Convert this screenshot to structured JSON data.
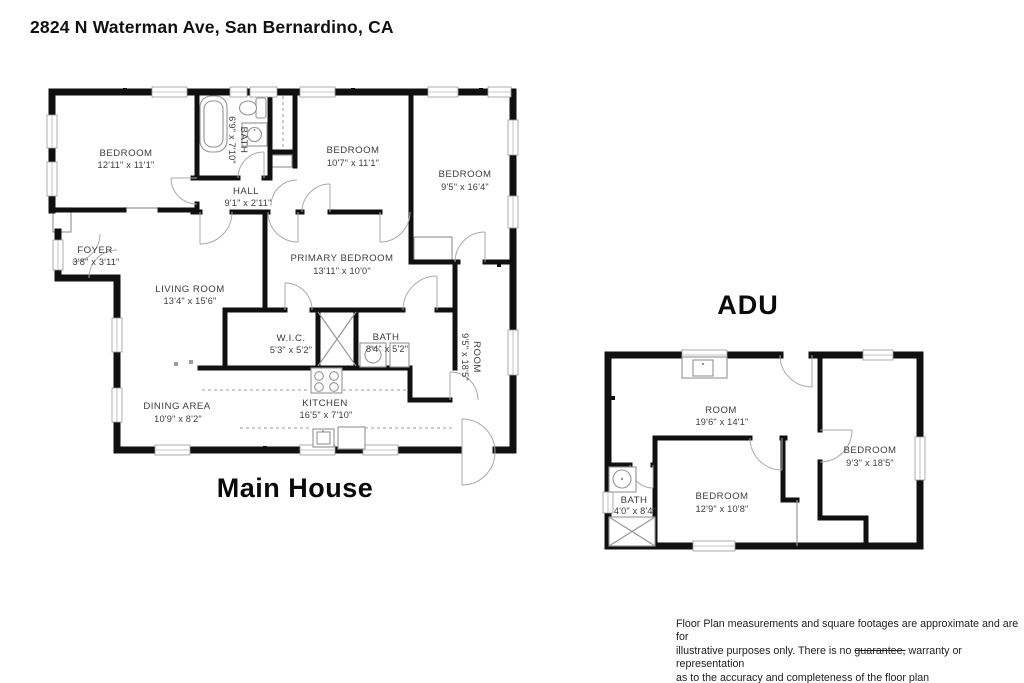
{
  "title": "2824 N Waterman Ave, San Bernardino, CA",
  "plans": {
    "main_house": {
      "label": "Main House",
      "rooms": {
        "bedroom1": {
          "name": "BEDROOM",
          "dims": "12'11\" x 11'1\""
        },
        "bath1": {
          "name": "BATH",
          "dims": "6'9\" x 7'10\""
        },
        "bedroom2": {
          "name": "BEDROOM",
          "dims": "10'7\" x 11'1\""
        },
        "bedroom3": {
          "name": "BEDROOM",
          "dims": "9'5\" x 16'4\""
        },
        "hall": {
          "name": "HALL",
          "dims": "9'1\" x 2'11\""
        },
        "foyer": {
          "name": "FOYER",
          "dims": "3'8\" x 3'11\""
        },
        "living_room": {
          "name": "LIVING ROOM",
          "dims": "13'4\" x 15'6\""
        },
        "primary_bedroom": {
          "name": "PRIMARY BEDROOM",
          "dims": "13'11\" x 10'0\""
        },
        "wic": {
          "name": "W.I.C.",
          "dims": "5'3\" x 5'2\""
        },
        "bath2": {
          "name": "BATH",
          "dims": "8'4\" x 5'2\""
        },
        "side_room": {
          "name": "ROOM",
          "dims": "9'5\" x 18'5\""
        },
        "dining": {
          "name": "DINING AREA",
          "dims": "10'9\" x 8'2\""
        },
        "kitchen": {
          "name": "KITCHEN",
          "dims": "16'5\" x 7'10\""
        }
      }
    },
    "adu": {
      "label": "ADU",
      "rooms": {
        "room": {
          "name": "ROOM",
          "dims": "19'6\" x 14'1\""
        },
        "bedroom_right": {
          "name": "BEDROOM",
          "dims": "9'3\" x 18'5\""
        },
        "bath": {
          "name": "BATH",
          "dims": "4'0\" x 8'4\""
        },
        "bedroom_bottom": {
          "name": "BEDROOM",
          "dims": "12'9\" x 10'8\""
        }
      }
    }
  },
  "disclaimer": {
    "line1": "Floor Plan measurements and square footages are approximate and are for",
    "line2_pre": "illustrative purposes only. There is no ",
    "line2_struck": "guarantee,",
    "line2_post": " warranty or representation",
    "line3": "as to the accuracy and completeness of the floor plan"
  }
}
